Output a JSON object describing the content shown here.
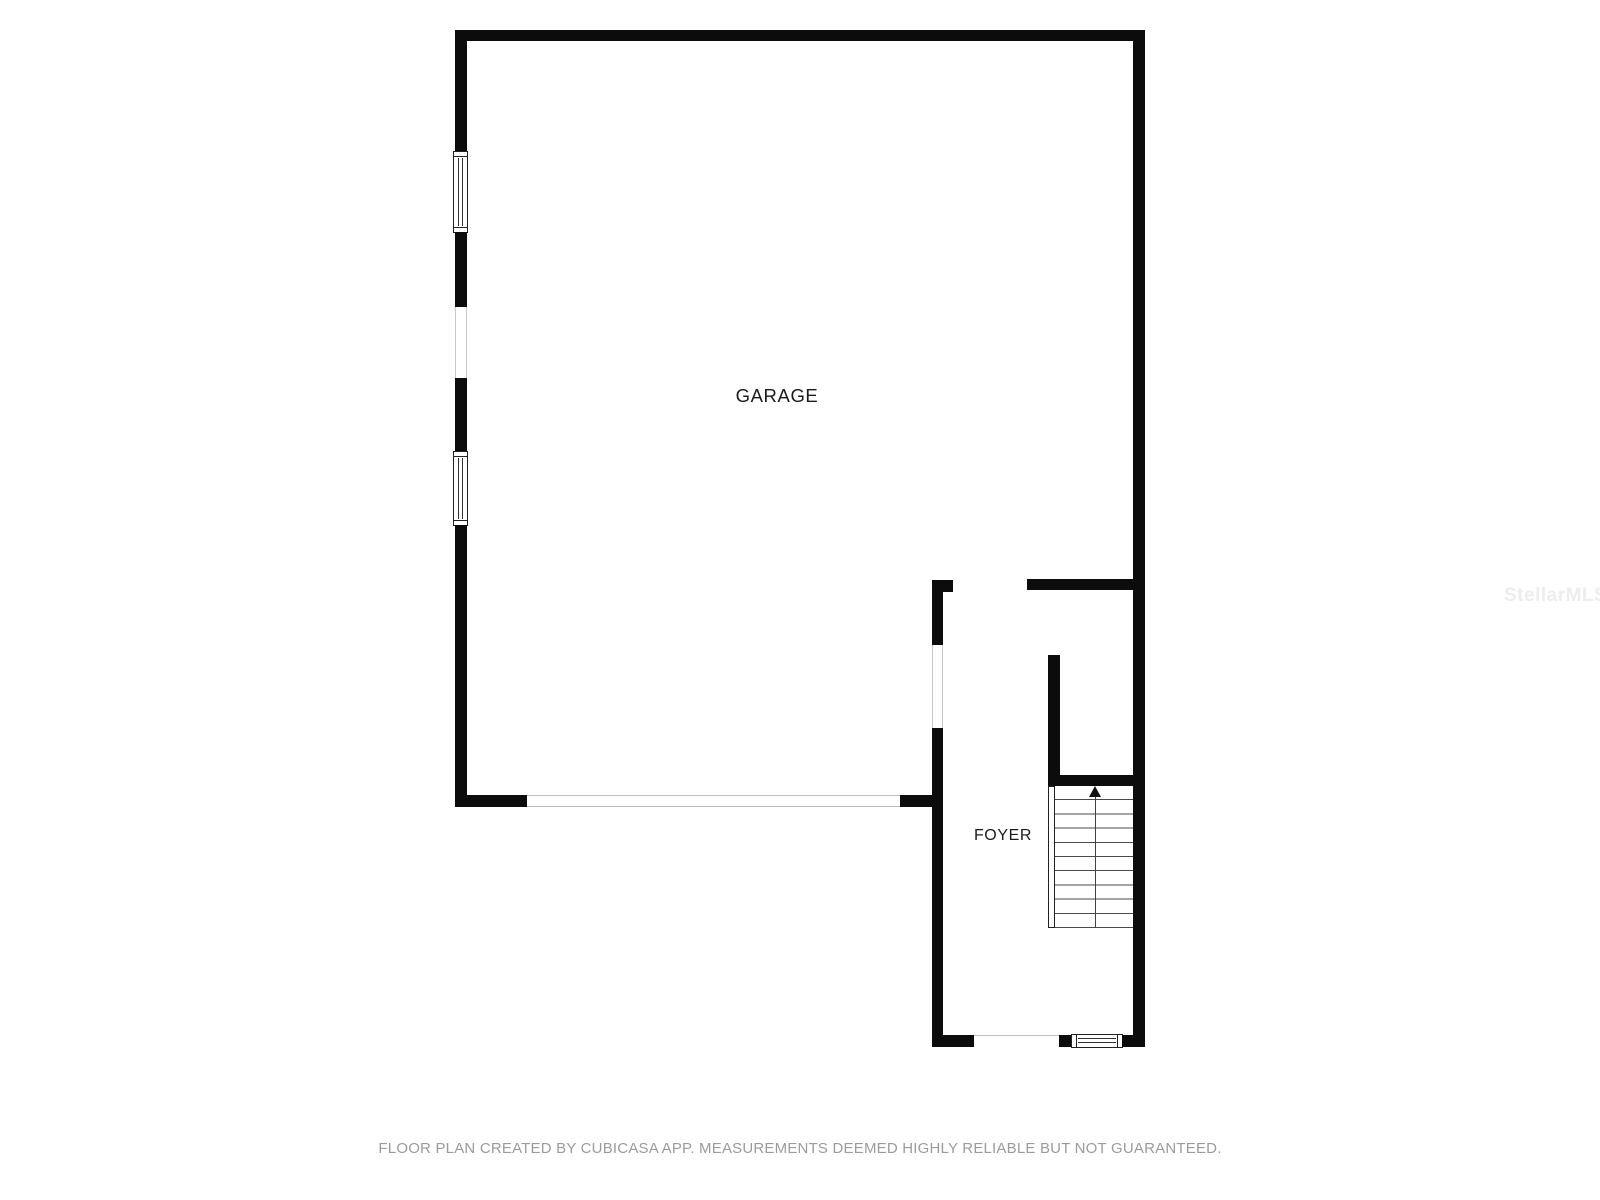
{
  "floor_plan": {
    "labels": {
      "garage": "GARAGE",
      "foyer": "FOYER"
    },
    "stairs": {
      "arrow_icon": "arrow-up-icon",
      "direction": "up",
      "tread_count": 10
    },
    "features": [
      "left-wall-window-upper",
      "left-wall-opening",
      "left-wall-window-lower",
      "garage-door-opening",
      "garage-to-foyer-doorway",
      "foyer-top-opening",
      "foyer-entry-opening",
      "foyer-front-door-sill"
    ],
    "colors": {
      "wall": "#0c0c0c",
      "background": "#ffffff",
      "label_text": "#1b1b1b",
      "tread_line": "#4a4a4a",
      "opening_edge": "#c9c9c9"
    }
  },
  "watermark": {
    "text": "StellarMLS",
    "color": "#ededed"
  },
  "footer": {
    "text": "FLOOR PLAN CREATED BY CUBICASA APP. MEASUREMENTS DEEMED HIGHLY RELIABLE BUT NOT GUARANTEED.",
    "color": "#9b9b9b"
  }
}
